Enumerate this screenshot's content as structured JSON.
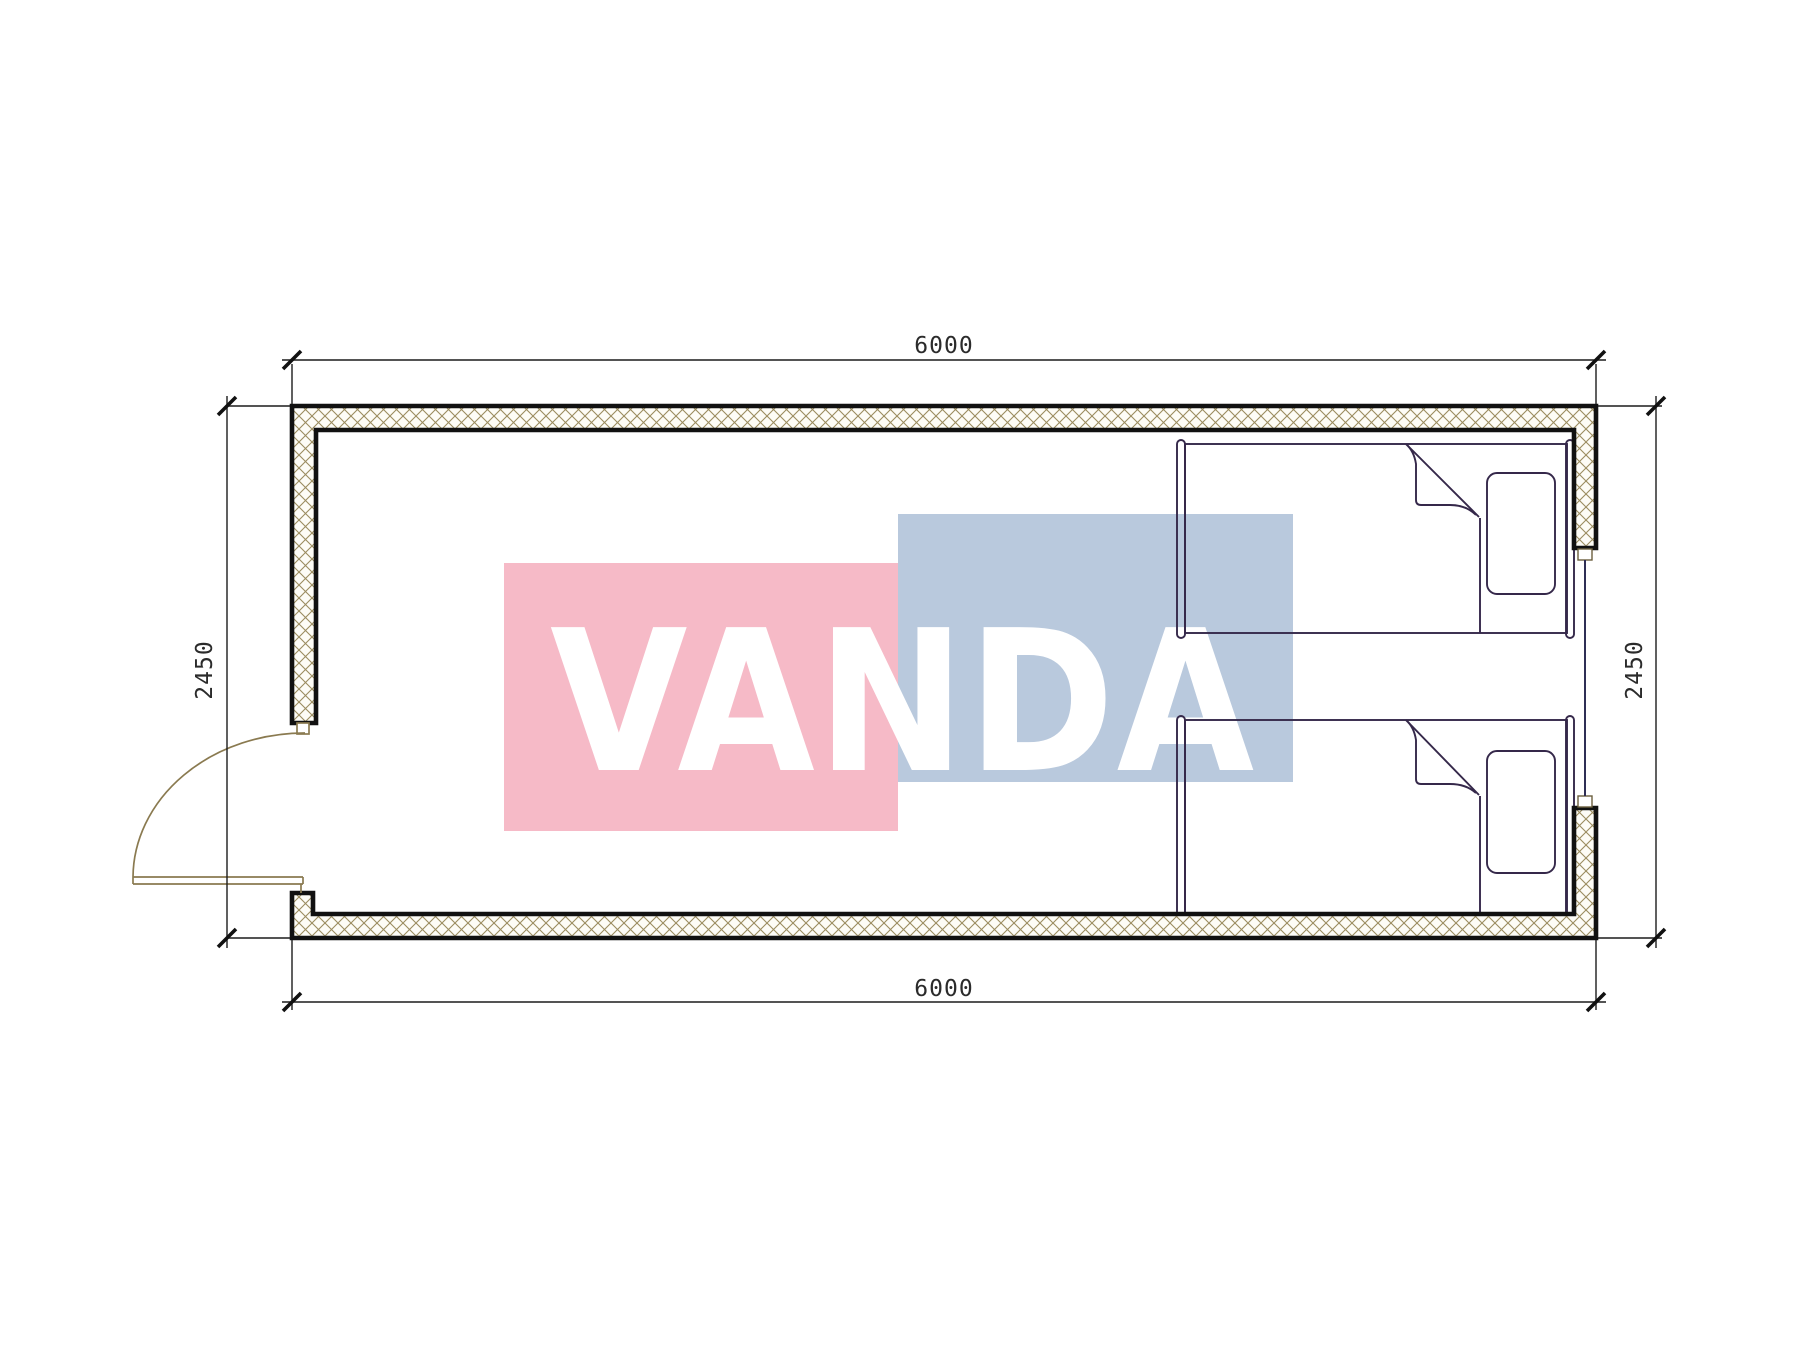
{
  "drawing": {
    "type": "floor-plan",
    "room": {
      "width_label_top": "6000",
      "width_label_bottom": "6000",
      "height_label_left": "2450",
      "height_label_right": "2450"
    }
  },
  "dimensions": {
    "top": {
      "label": "6000"
    },
    "bottom": {
      "label": "6000"
    },
    "left": {
      "label": "2450"
    },
    "right": {
      "label": "2450"
    }
  },
  "watermark": {
    "text": "VANDA",
    "pink": "#f6bac7",
    "blue": "#b9c9dd",
    "text_color": "#ffffff"
  },
  "colors": {
    "bed_fill": "rgba(100,64,88,0.66)",
    "bed_outline": "#35284a",
    "wall_hatch": "#9b8c5f",
    "wall_hatch_bg": "#fdfcf6",
    "wall_outline": "#111111",
    "dimension_line": "#1c1c1c",
    "door": "#8a7a50",
    "window_line": "#2f2f55"
  },
  "elements": {
    "beds": [
      "bed-top",
      "bed-bottom"
    ],
    "openings": [
      "door-left",
      "window-right"
    ]
  }
}
